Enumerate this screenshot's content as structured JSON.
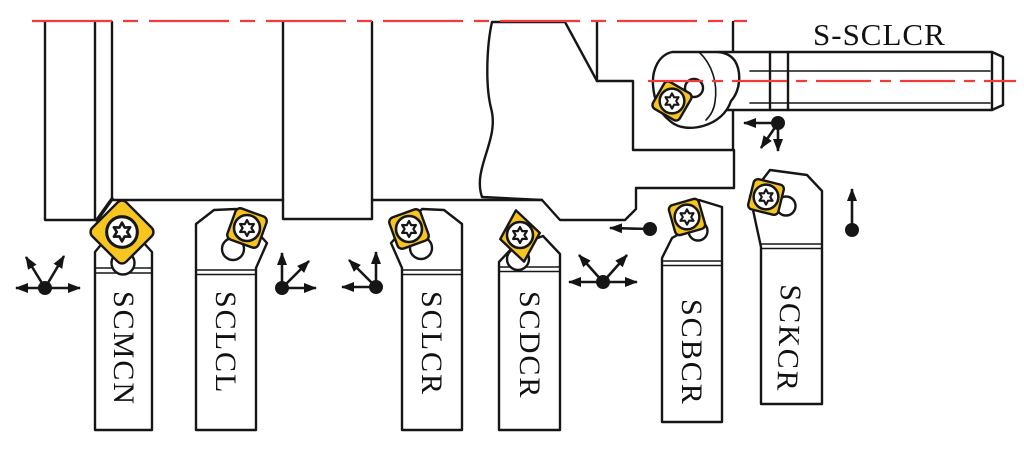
{
  "caption": {
    "text": "S-SCLCR"
  },
  "tools": [
    {
      "label": "SCMCN",
      "insert": "square-insert",
      "feed_directions": [
        "left",
        "right",
        "up-left",
        "up-right"
      ]
    },
    {
      "label": "SCLCL",
      "insert": "square-insert",
      "feed_directions": [
        "up",
        "right",
        "up-right"
      ]
    },
    {
      "label": "SCLCR",
      "insert": "square-insert",
      "feed_directions": [
        "up",
        "left",
        "up-left"
      ]
    },
    {
      "label": "SCDCR",
      "insert": "rhombic-insert",
      "feed_directions": [
        "left",
        "right",
        "up-left",
        "up-right"
      ]
    },
    {
      "label": "SCBCR",
      "insert": "square-insert",
      "feed_directions": [
        "left"
      ]
    },
    {
      "label": "SCKCR",
      "insert": "square-insert",
      "feed_directions": [
        "up"
      ]
    }
  ],
  "boring_tool": {
    "label": "S-SCLCR",
    "insert": "square-insert",
    "feed_directions": [
      "left",
      "down",
      "down-left"
    ]
  },
  "icons": {
    "screw": "torx-screw-icon",
    "feed_origin": "feed-origin-dot",
    "feed_arrow": "feed-arrow-icon"
  },
  "colors": {
    "insert_yellow": "#f6c51f",
    "centerline_red": "#f23b3b",
    "outline_black": "#161616"
  }
}
